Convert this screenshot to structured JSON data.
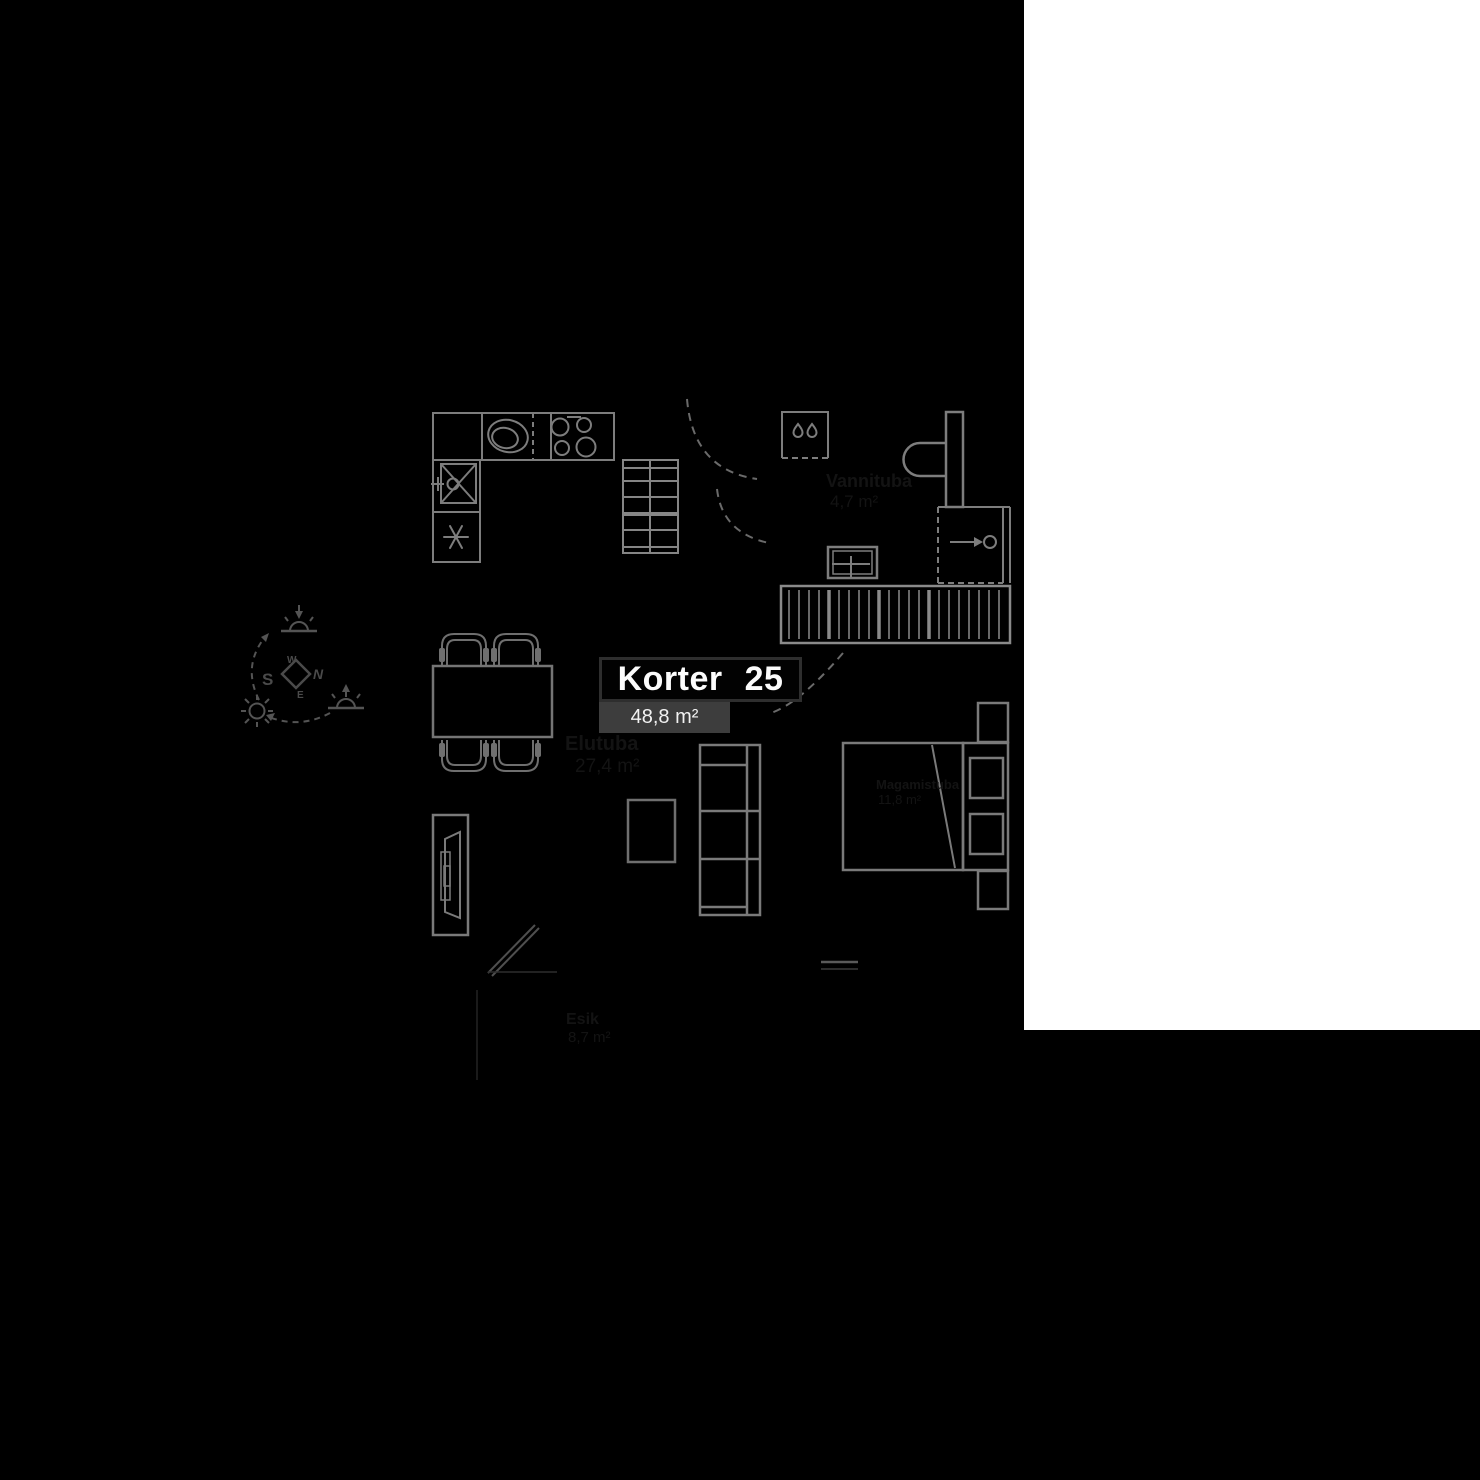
{
  "plan": {
    "unit": {
      "label": "Korter 25",
      "area": "48,8 m²"
    },
    "rooms": [
      {
        "name": "Elutuba",
        "area": "27,4 m²"
      },
      {
        "name": "Vannituba",
        "area": "4,7 m²"
      },
      {
        "name": "Magamistuba",
        "area": "11,8 m²"
      },
      {
        "name": "Esik",
        "area": "8,7 m²"
      }
    ],
    "compass": {
      "n": "N",
      "e": "E",
      "s": "S",
      "w": "W"
    },
    "furniture_icons": [
      "kitchen-counter",
      "kitchen-sink",
      "stove-burners",
      "prep-sink",
      "fridge-snowflake-icon",
      "towel-ladder",
      "shower",
      "water-drop-icon",
      "toilet",
      "washbasin",
      "shower-enclosure",
      "wardrobe",
      "dining-table",
      "dining-chair",
      "sofa",
      "coffee-table",
      "tv-stand",
      "bed",
      "pillow",
      "nightstand",
      "sun-path-diagram",
      "sun-icon",
      "sunrise-icon",
      "sunset-icon",
      "compass-rose",
      "door-swing-arc",
      "entrance-door"
    ]
  },
  "colors": {
    "background": "#000000",
    "blank_panel": "#ffffff",
    "furniture_line": "#7d7d7d",
    "diagram_line": "#545454",
    "faint_text": "#131313",
    "unit_box_border": "#2e2e2e",
    "area_badge_bg": "#3d3d3d",
    "label_text": "#fcfcfc"
  }
}
